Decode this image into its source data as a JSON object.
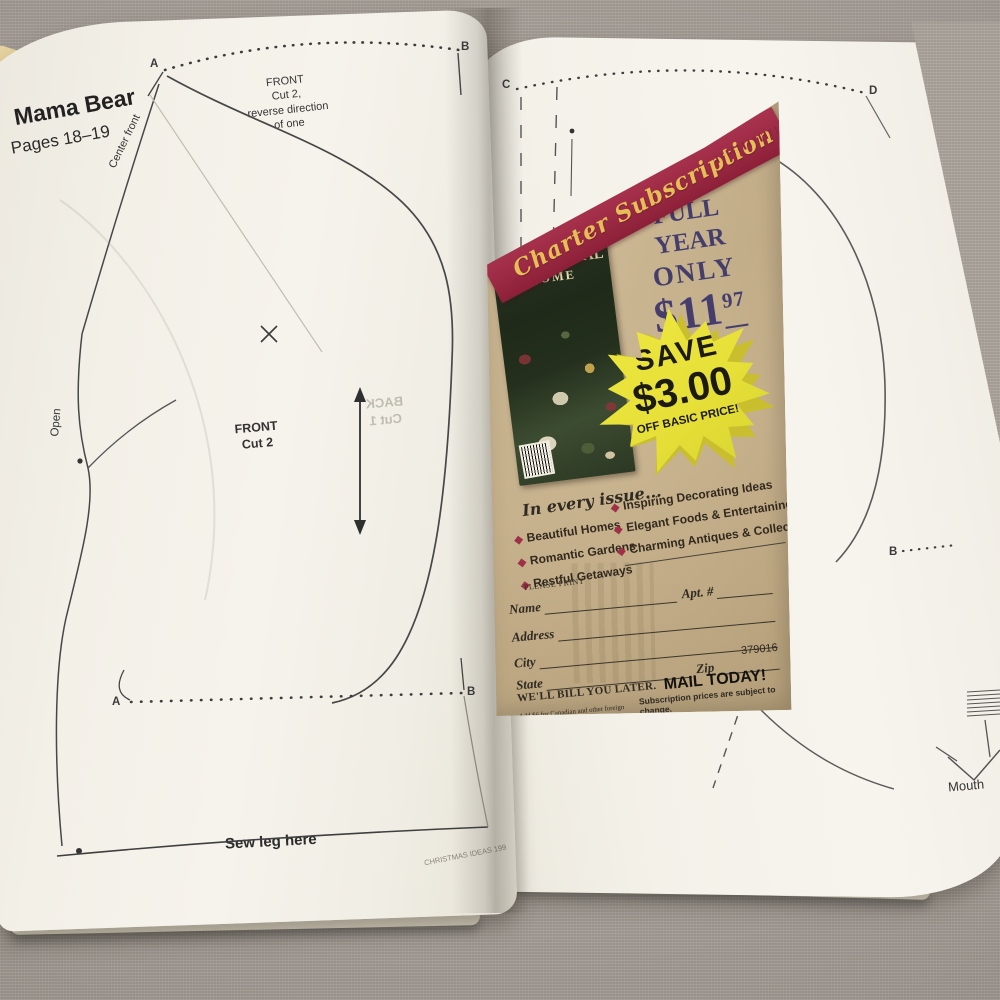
{
  "photo_alt": "Open craft magazine showing Mama Bear sewing pattern pages with a Traditional Home charter subscription insert card",
  "left_page": {
    "title": "Mama Bear",
    "pages_ref": "Pages 18–19",
    "center_front_label": "Center front",
    "front_reverse_note": [
      "FRONT",
      "Cut 2,",
      "reverse direction",
      "of one"
    ],
    "front_label": [
      "FRONT",
      "Cut 2"
    ],
    "open_label": "Open",
    "sew_leg_label": "Sew leg here",
    "ghost_back_label": [
      "BACK",
      "Cut 1"
    ],
    "footer": "CHRISTMAS IDEAS 199",
    "markers": {
      "top_left": "A",
      "top_right": "B",
      "bottom_left": "A",
      "bottom_right": "B"
    }
  },
  "right_page": {
    "markers": {
      "arc_left": "C",
      "arc_right": "D",
      "side": "B"
    },
    "mouth_label": "Mouth"
  },
  "card": {
    "banner": "Charter Subscription Offer",
    "magazine": {
      "title_line1": "TRADITIONAL",
      "title_line2": "HOME"
    },
    "offer": {
      "line1": "ONE",
      "line2": "FULL YEAR",
      "line3": "ONLY",
      "price": "$11",
      "cents": "97",
      "issues": "(6 ISSUES)"
    },
    "starburst": {
      "line1": "SAVE",
      "line2": "$3.00",
      "line3": "OFF BASIC PRICE!"
    },
    "issue_section": {
      "heading": "In every issue...",
      "col1": [
        "Beautiful Homes",
        "Romantic Gardens",
        "Restful Getaways"
      ],
      "col2": [
        "Inspiring Decorating Ideas",
        "Elegant Foods & Entertaining",
        "Charming Antiques & Collectibles"
      ]
    },
    "form": {
      "print_note": "PLEASE PRINT",
      "name_label": "Name",
      "apt_label": "Apt. #",
      "address_label": "Address",
      "city_label": "City",
      "state_label": "State",
      "zip_label": "Zip",
      "code": "379016",
      "bill_note": "WE'LL BILL YOU LATER.",
      "mail_note": "MAIL TODAY!",
      "foreign_note": "Add $6 for Canadian and other foreign subscriptions.",
      "change_note": "Subscription prices are subject to change."
    },
    "colors": {
      "banner_red": "#9e2b45",
      "banner_gold": "#e7bd58",
      "kraft": "#c9b289",
      "navy": "#453e6d",
      "starburst_yellow": "#e9e33d",
      "bullet_red": "#a03048"
    }
  }
}
